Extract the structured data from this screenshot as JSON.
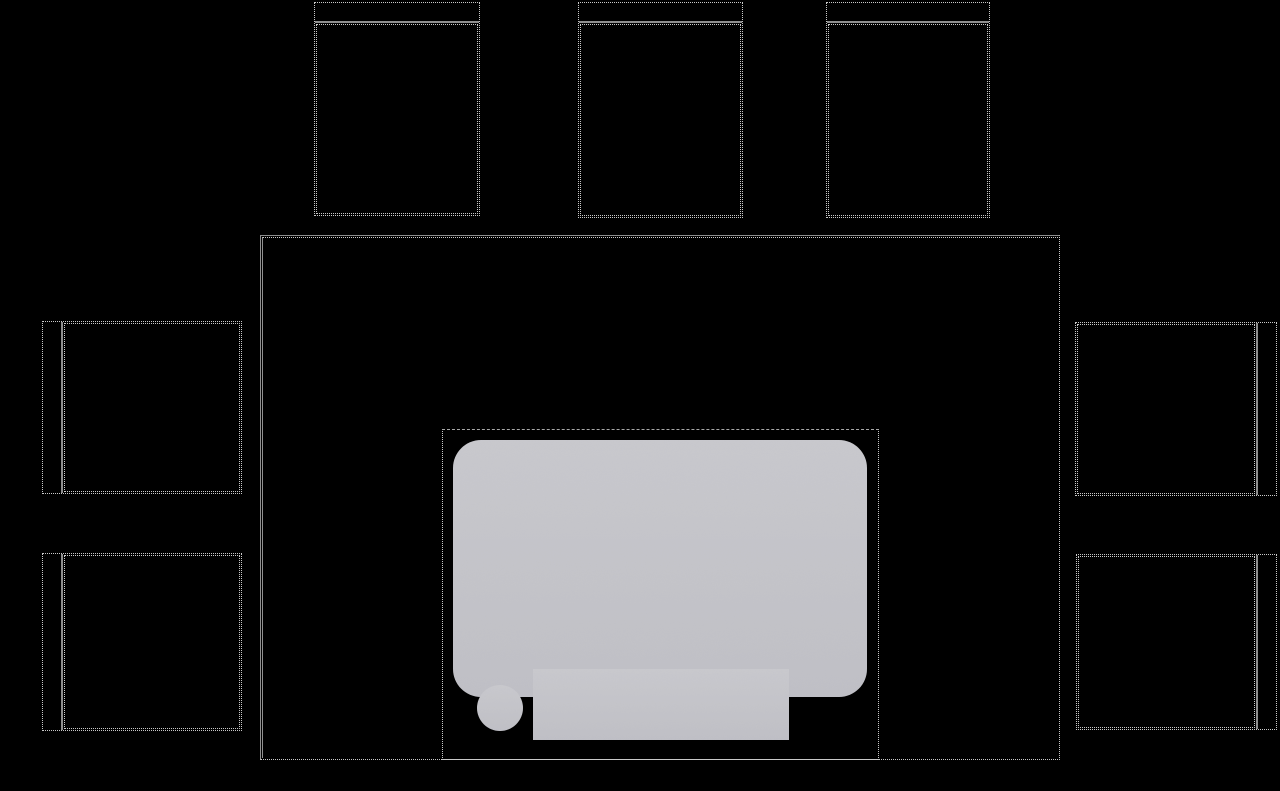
{
  "app": {
    "description": "dark tabletop layout with empty dotted placeholder zones and a gray object silhouette",
    "visible_text": ""
  },
  "palette": {
    "background": "#000000",
    "solid_line": "#8f8f8f",
    "dotted_line": "#c9c9c9",
    "dashed_line": "#a8a8a8",
    "object_fill_top": "#c9c9ce",
    "object_fill_bottom": "#c0c0c6",
    "object_grain": "#737378"
  },
  "canvas": {
    "width": 1280,
    "height": 791
  },
  "zones": [
    {
      "name": "slot-top-1",
      "orientation": "top",
      "x": 314,
      "y": 2,
      "w": 166,
      "h": 214
    },
    {
      "name": "slot-top-2",
      "orientation": "top",
      "x": 578,
      "y": 2,
      "w": 165,
      "h": 216
    },
    {
      "name": "slot-top-3",
      "orientation": "top",
      "x": 826,
      "y": 2,
      "w": 164,
      "h": 216
    },
    {
      "name": "slot-left-1",
      "orientation": "left",
      "x": 42,
      "y": 321,
      "w": 200,
      "h": 173
    },
    {
      "name": "slot-left-2",
      "orientation": "left",
      "x": 42,
      "y": 553,
      "w": 200,
      "h": 178
    },
    {
      "name": "slot-right-1",
      "orientation": "right",
      "x": 1075,
      "y": 322,
      "w": 202,
      "h": 174
    },
    {
      "name": "slot-right-2",
      "orientation": "right",
      "x": 1076,
      "y": 554,
      "w": 201,
      "h": 176
    }
  ],
  "board": {
    "x": 260,
    "y": 235,
    "w": 800,
    "h": 525
  },
  "stage": {
    "x": 442,
    "y": 429,
    "w": 437,
    "h": 331
  },
  "object": {
    "x": 442,
    "y": 429,
    "w": 437,
    "h": 331,
    "body": {
      "x": 11,
      "y": 11,
      "w": 414,
      "h": 257,
      "rx": 28
    },
    "base_tab": {
      "x": 91,
      "y": 240,
      "w": 256,
      "h": 71
    },
    "foot": {
      "cx": 58,
      "cy": 279,
      "r": 23
    }
  }
}
